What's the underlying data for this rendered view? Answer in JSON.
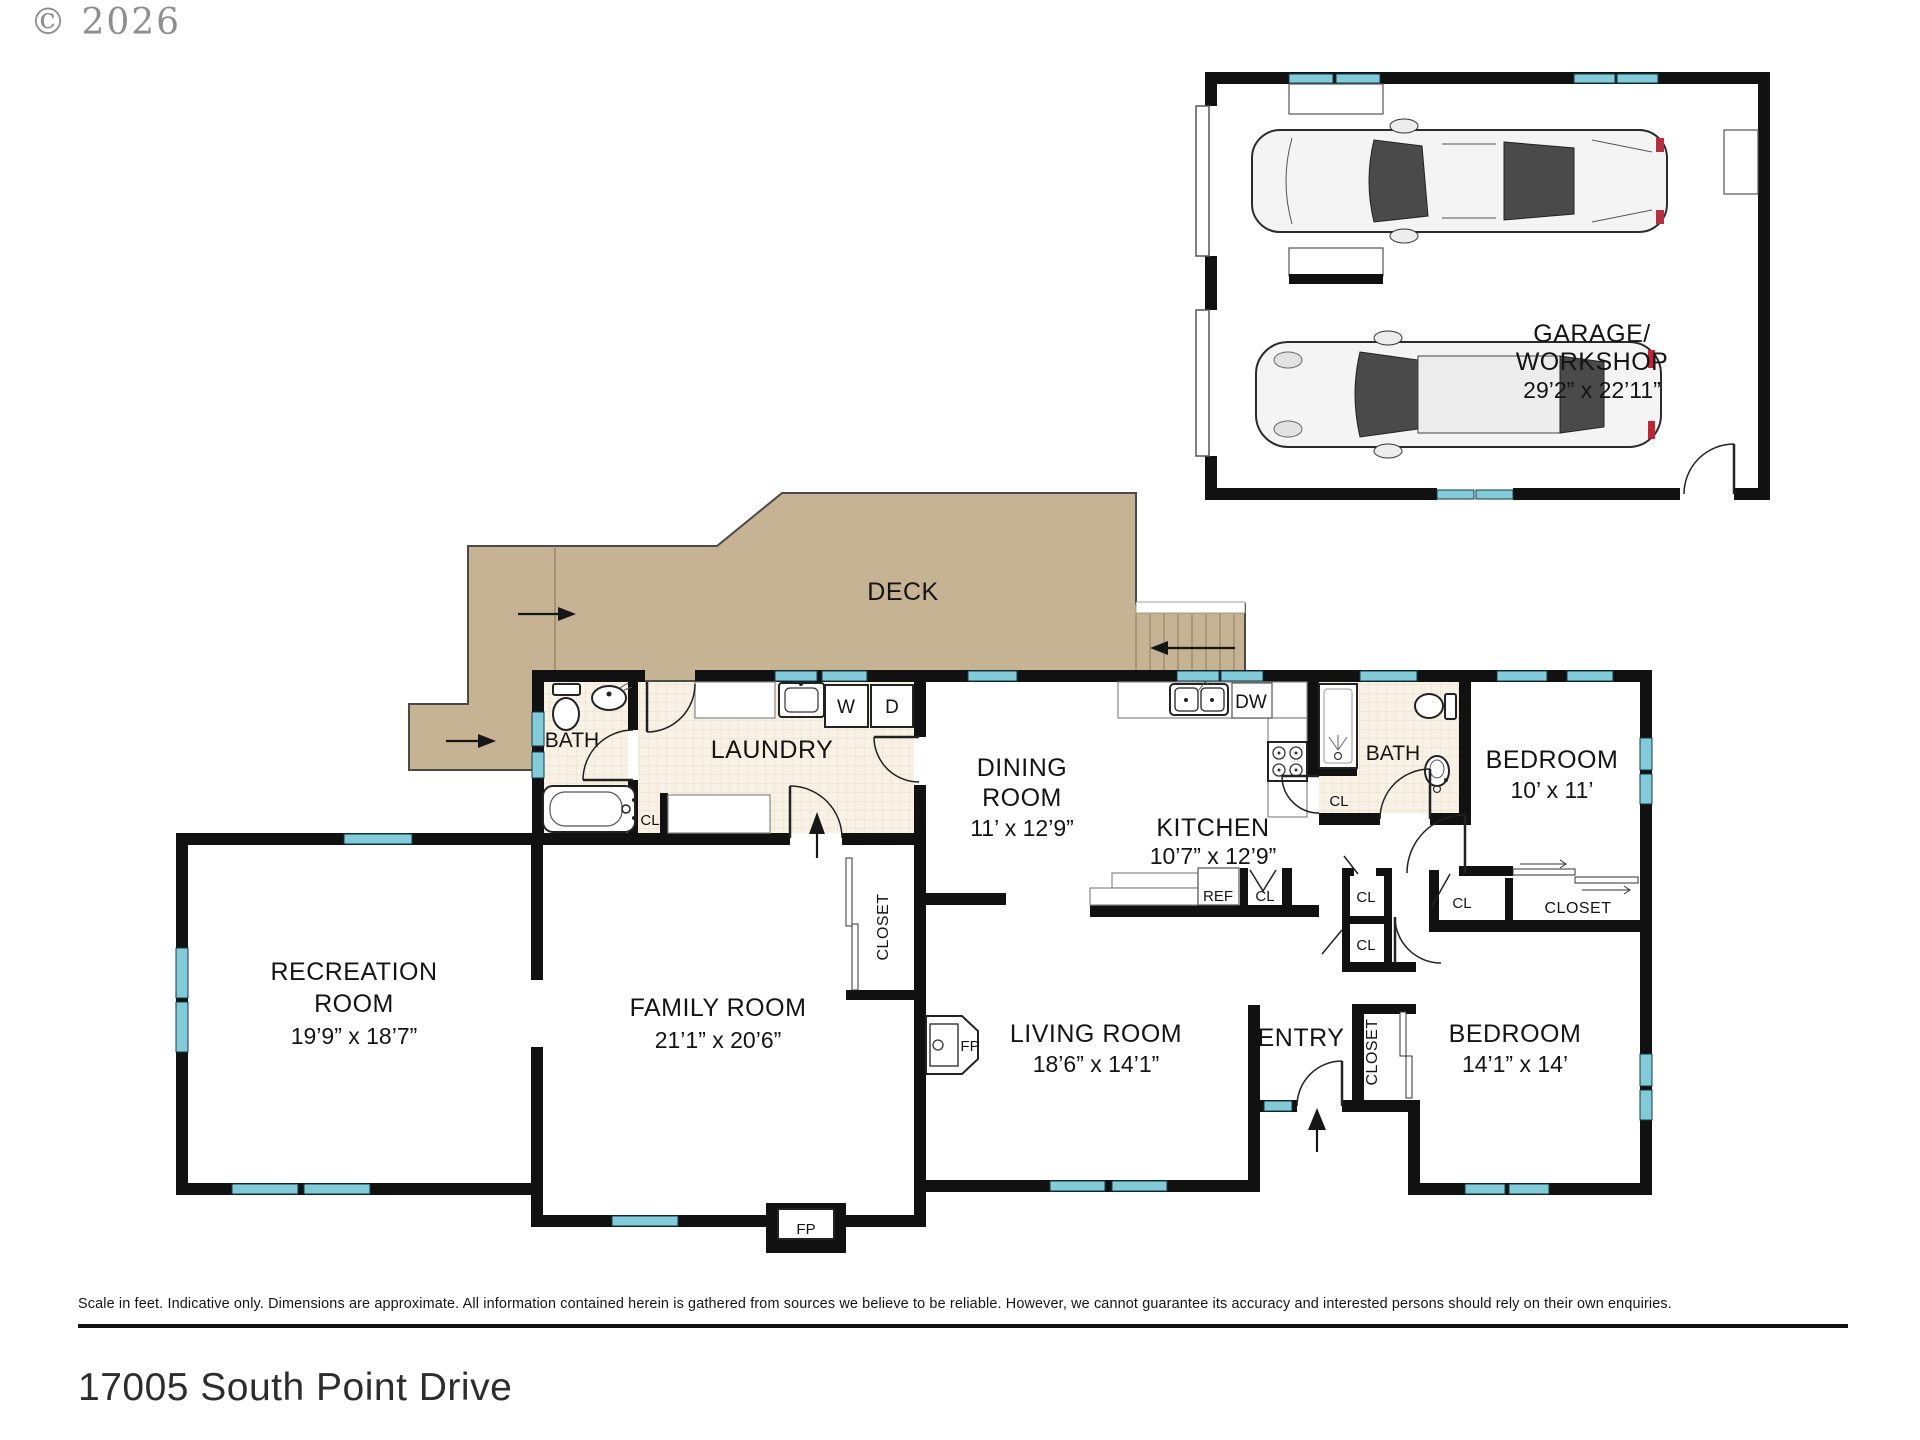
{
  "page": {
    "copyright": "© 2026",
    "disclaimer": "Scale in feet. Indicative only. Dimensions are approximate. All information contained herein is gathered from sources we believe to be reliable. However, we cannot guarantee its accuracy and interested persons should rely on their own enquiries.",
    "address": "17005 South Point Drive"
  },
  "rooms": {
    "garage": {
      "line1": "GARAGE/",
      "line2": "WORKSHOP",
      "dims": "29’2” x 22’11”"
    },
    "deck": {
      "name": "DECK"
    },
    "bath_upper": {
      "name": "BATH"
    },
    "laundry": {
      "name": "LAUNDRY"
    },
    "dining": {
      "line1": "DINING",
      "line2": "ROOM",
      "dims": "11’ x 12’9”"
    },
    "kitchen": {
      "name": "KITCHEN",
      "dims": "10’7” x 12’9”"
    },
    "bath_main": {
      "name": "BATH"
    },
    "bedroom_small": {
      "name": "BEDROOM",
      "dims": "10’ x 11’"
    },
    "recreation": {
      "line1": "RECREATION",
      "line2": "ROOM",
      "dims": "19’9” x 18’7”"
    },
    "family": {
      "name": "FAMILY ROOM",
      "dims": "21’1” x 20’6”"
    },
    "living": {
      "name": "LIVING ROOM",
      "dims": "18’6” x 14’1”"
    },
    "entry": {
      "name": "ENTRY"
    },
    "bedroom_large": {
      "name": "BEDROOM",
      "dims": "14’1” x 14’"
    }
  },
  "fixtures": {
    "washer": "W",
    "dryer": "D",
    "dishwasher": "DW",
    "fridge": "REF",
    "fireplace": "FP",
    "closet_abbr": "CL",
    "closet": "CLOSET"
  },
  "colors": {
    "wall": "#111111",
    "window_glass": "#84cbd9",
    "deck": "#c5b393",
    "tile": "#f8f1e5",
    "disclaimer_line": "#111111"
  }
}
